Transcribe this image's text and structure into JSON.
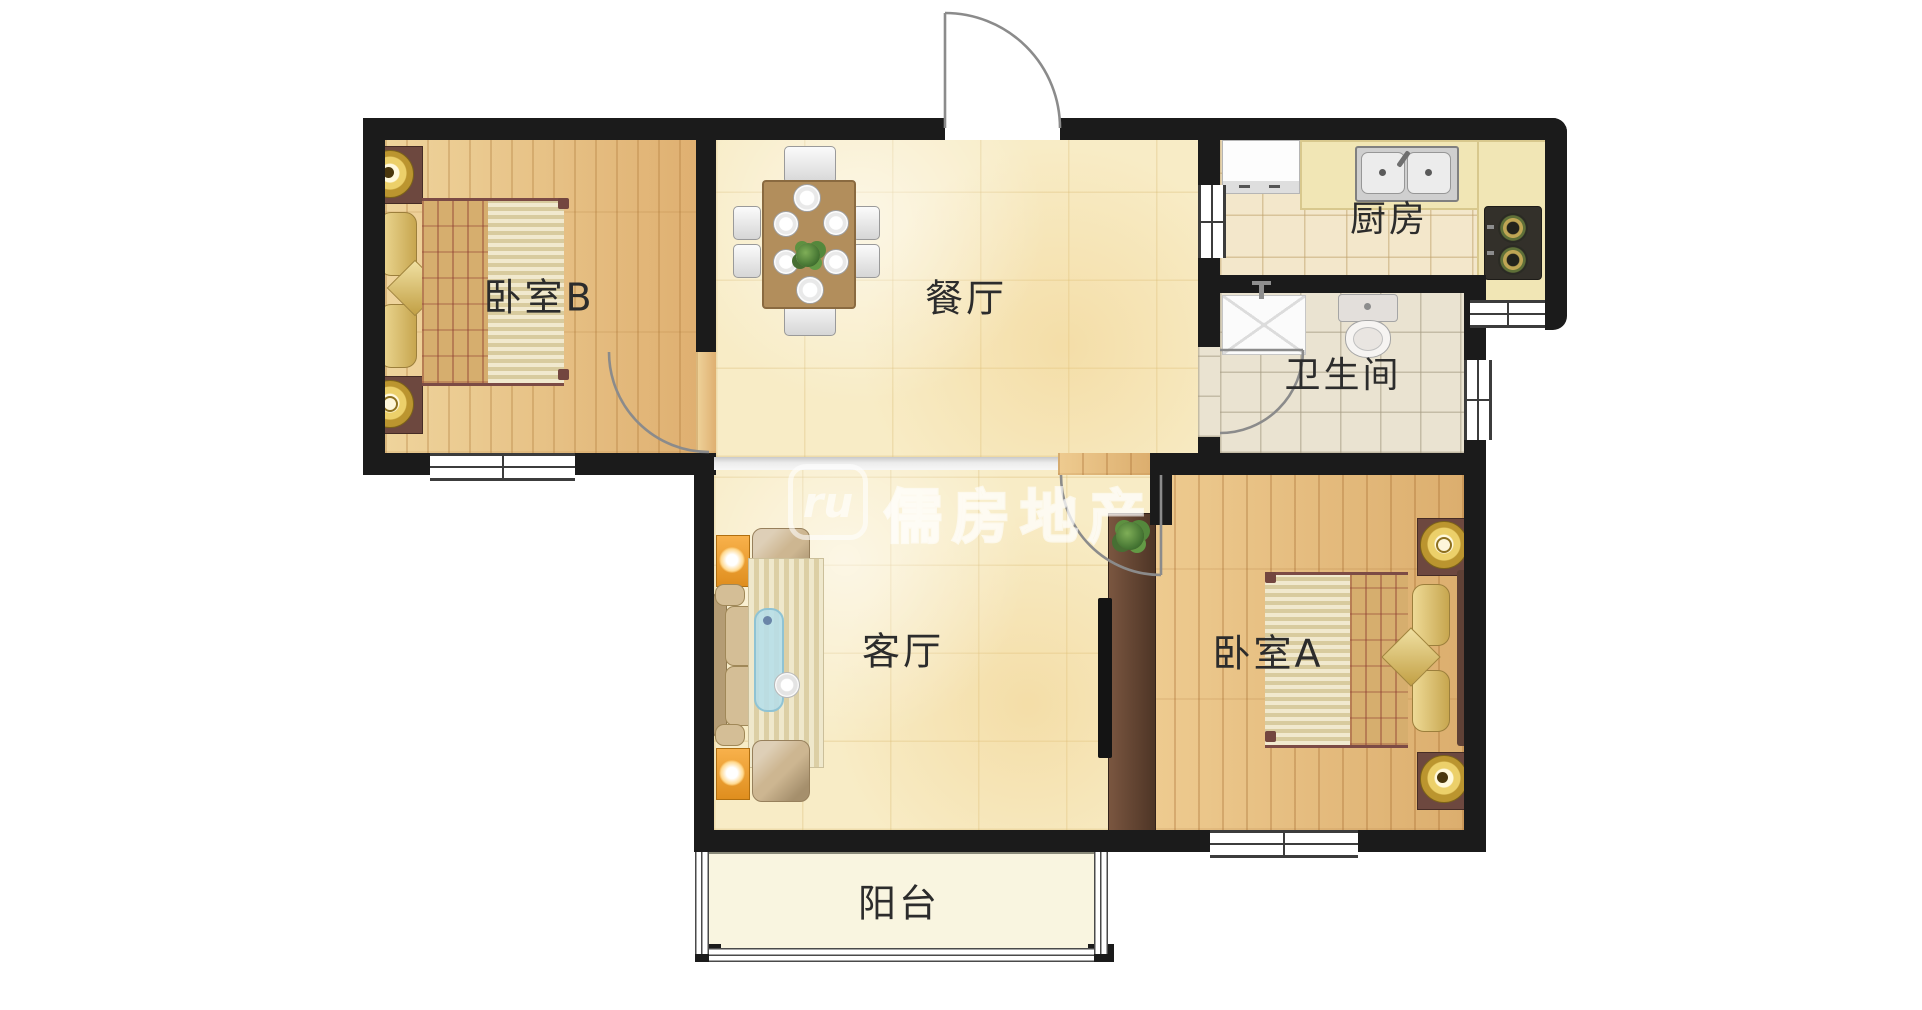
{
  "type": "residential-floor-plan",
  "rooms": [
    {
      "id": "bedroom-b",
      "label": "卧室B"
    },
    {
      "id": "dining-room",
      "label": "餐厅"
    },
    {
      "id": "kitchen",
      "label": "厨房"
    },
    {
      "id": "bathroom",
      "label": "卫生间"
    },
    {
      "id": "living-room",
      "label": "客厅"
    },
    {
      "id": "bedroom-a",
      "label": "卧室A"
    },
    {
      "id": "balcony",
      "label": "阳台"
    }
  ],
  "watermark": {
    "logo_text": "ru",
    "brand_text": "儒房地产"
  },
  "colors": {
    "wall": "#1b1b1b",
    "wood_floor": "#e8c186",
    "warm_tile": "#f8ecc6",
    "kitchen_tile": "#f3e7cb",
    "bath_tile": "#eae3d1",
    "balcony_floor": "#f9f5e0",
    "counter": "#f1e6b5",
    "lamp_table_orange": "#f5a83a",
    "watermark": "#ffffff"
  }
}
